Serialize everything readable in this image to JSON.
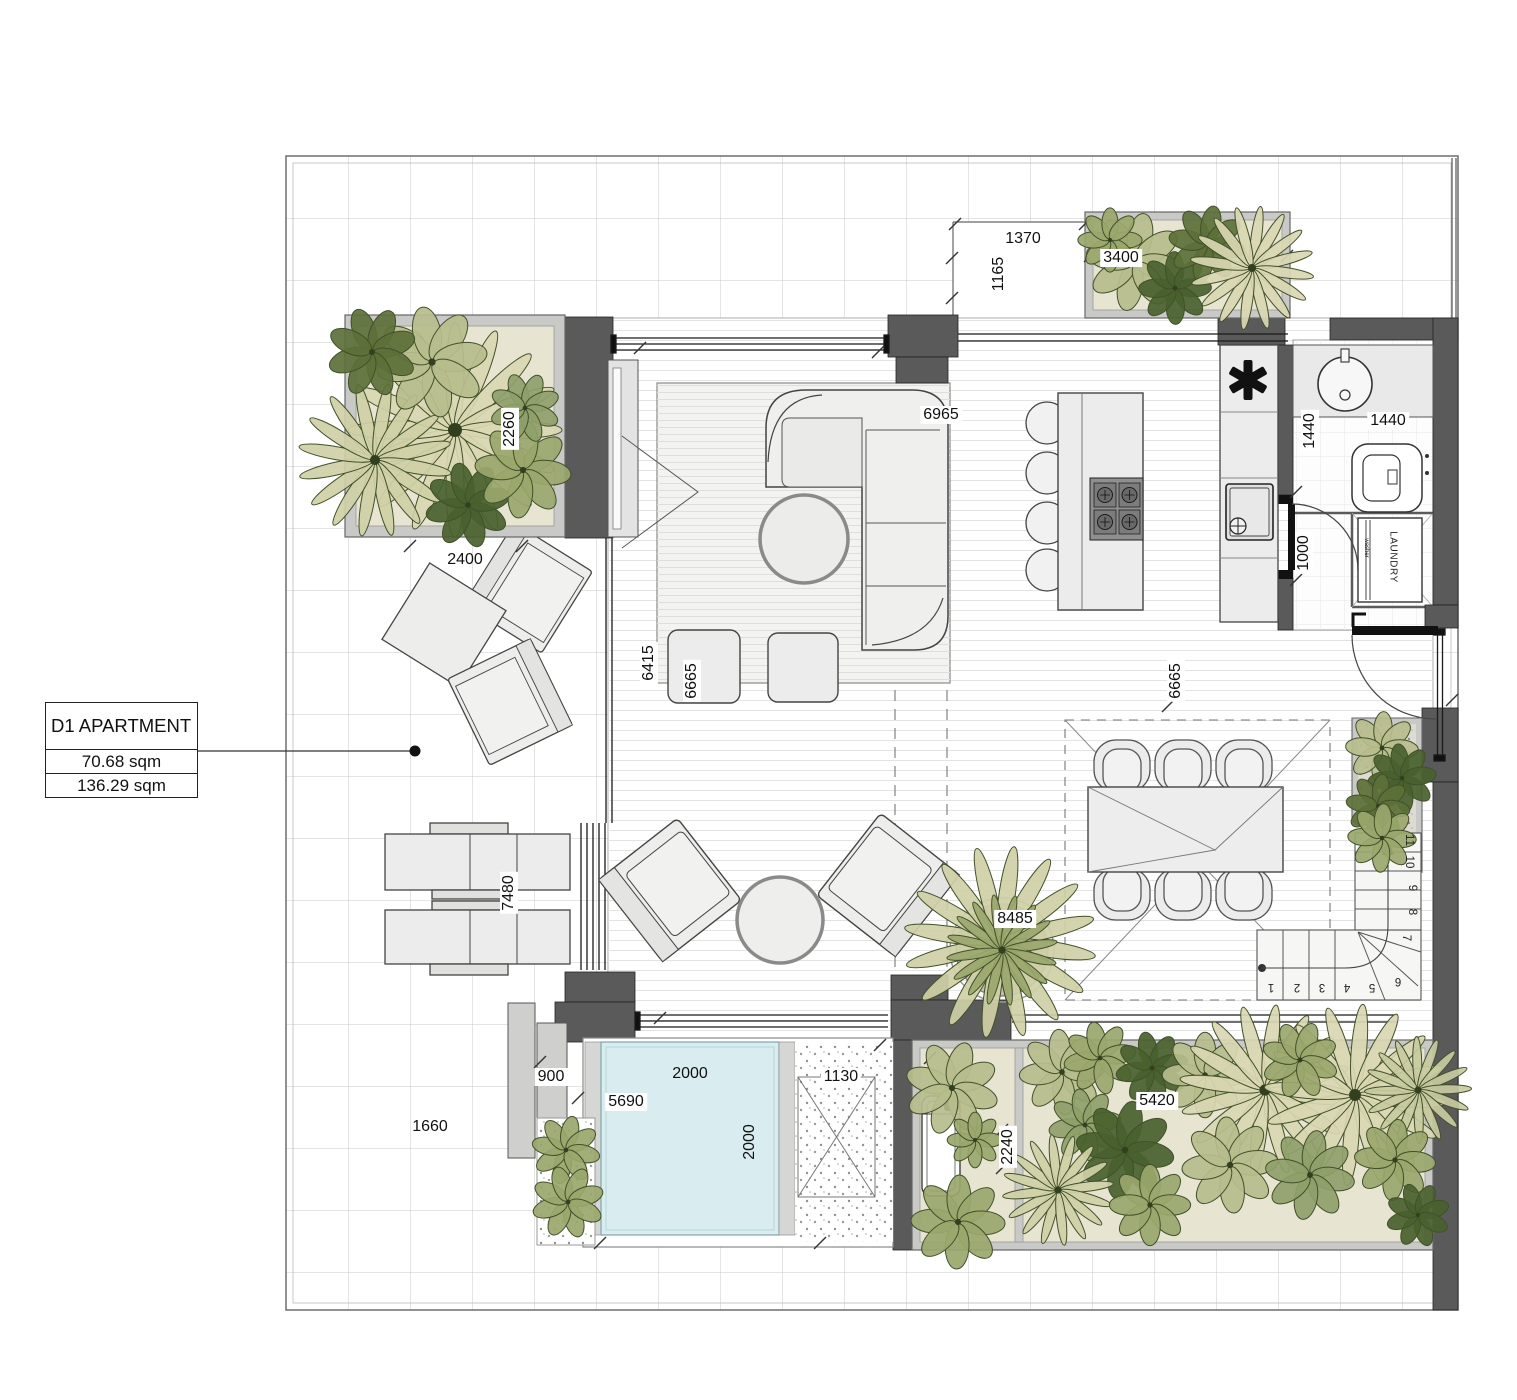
{
  "title_box": {
    "name": "D1 APARTMENT",
    "area_internal": "70.68 sqm",
    "area_total": "136.29 sqm"
  },
  "dimensions": {
    "top_recess_width": "1370",
    "top_recess_depth": "1165",
    "top_planter": "3400",
    "left_planter": "2260",
    "terrace_seating": "2400",
    "living_width": "6965",
    "bath_depth": "1440",
    "bath_width": "1440",
    "hall_width": "1000",
    "living_depth": "6415",
    "rug_depth": "6665",
    "dining_depth": "6665",
    "outdoor_table": "7480",
    "plant_pot": "8485",
    "bench": "900",
    "pool_terrace": "5690",
    "pool_width": "2000",
    "pool_length": "2000",
    "gravel_bed": "1130",
    "terrace_left": "1660",
    "right_planter": "5420",
    "right_planter_depth": "2240"
  },
  "labels": {
    "laundry": "LAUNDRY",
    "washer": "washer"
  },
  "stairs": {
    "lower": [
      "1",
      "2",
      "3",
      "4",
      "5",
      "6"
    ],
    "upper": [
      "7",
      "8",
      "9",
      "10",
      "11"
    ]
  },
  "icons": {
    "fridge_symbol": "asterisk-6-spoke"
  },
  "colors": {
    "wall": "#5a5a5a",
    "pool_water": "#d9ecef",
    "planter_bed": "#e7e5d2",
    "planter_frame": "#c9c9c7",
    "plant_pale": "#d9d7b2",
    "plant_mid": "#b7bd8d",
    "plant_olive": "#9aa76c",
    "plant_dark": "#5c7038",
    "furniture_fill": "#ececec"
  }
}
